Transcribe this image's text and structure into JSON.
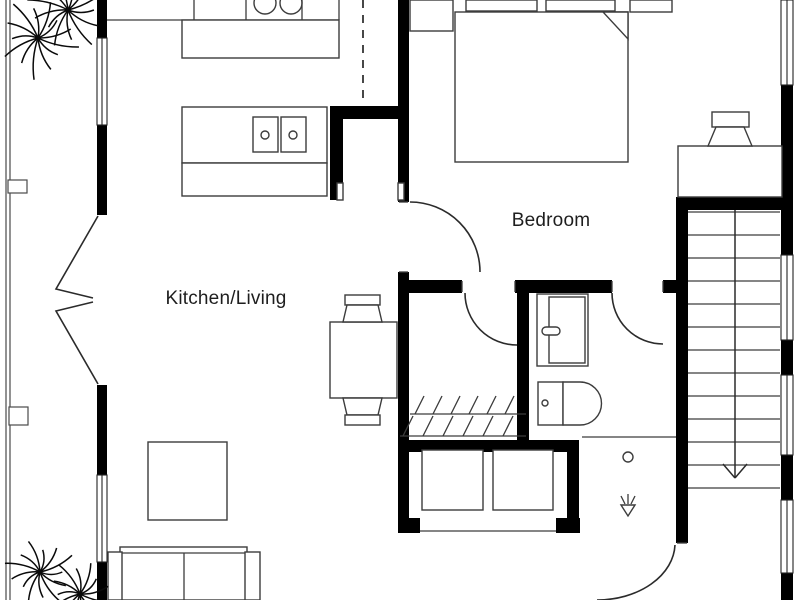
{
  "labels": {
    "bedroom": "Bedroom",
    "kitchen_living": "Kitchen/Living"
  },
  "label_positions": {
    "bedroom": {
      "x": 551,
      "y": 221
    },
    "kitchen_living": {
      "x": 226,
      "y": 299
    }
  },
  "colors": {
    "wall": "#000000",
    "line": "#3c3c3c",
    "door": "#2b2b2b",
    "thin": "#4a4a4a",
    "plant": "#0a0a0a",
    "background": "#ffffff",
    "text": "#1e1e1e"
  },
  "canvas": {
    "width": 800,
    "height": 600
  },
  "walls": [
    [
      97,
      0,
      10,
      38
    ],
    [
      97,
      125,
      10,
      90
    ],
    [
      97,
      385,
      10,
      90
    ],
    [
      97,
      562,
      10,
      38
    ],
    [
      781,
      85,
      12,
      170
    ],
    [
      781,
      340,
      12,
      35
    ],
    [
      781,
      455,
      12,
      45
    ],
    [
      781,
      573,
      12,
      27
    ],
    [
      398,
      0,
      11,
      202
    ],
    [
      398,
      272,
      11,
      261
    ],
    [
      398,
      280,
      64,
      13
    ],
    [
      515,
      280,
      97,
      13
    ],
    [
      663,
      280,
      19,
      13
    ],
    [
      517,
      293,
      12,
      147
    ],
    [
      398,
      440,
      180,
      12
    ],
    [
      567,
      440,
      12,
      93
    ],
    [
      398,
      518,
      22,
      15
    ],
    [
      556,
      518,
      24,
      15
    ],
    [
      330,
      106,
      78,
      13
    ],
    [
      330,
      106,
      13,
      94
    ],
    [
      676,
      197,
      12,
      346
    ],
    [
      676,
      197,
      107,
      13
    ]
  ],
  "windows": [
    [
      97,
      38,
      10,
      87
    ],
    [
      97,
      475,
      10,
      87
    ],
    [
      781,
      0,
      12,
      85
    ],
    [
      781,
      255,
      12,
      85
    ],
    [
      781,
      375,
      12,
      80
    ],
    [
      781,
      500,
      12,
      73
    ]
  ],
  "furniture": [
    {
      "name": "bed",
      "kind": "rect",
      "r": [
        455,
        12,
        173,
        150
      ]
    },
    {
      "name": "pillow",
      "kind": "rect",
      "r": [
        466,
        0,
        71,
        11
      ]
    },
    {
      "name": "pillow",
      "kind": "rect",
      "r": [
        546,
        0,
        69,
        11
      ]
    },
    {
      "name": "blanket-fold",
      "kind": "path",
      "d": "M603,12 L628,12 L628,39 Z"
    },
    {
      "name": "nightstand",
      "kind": "rect",
      "r": [
        410,
        0,
        43,
        31
      ]
    },
    {
      "name": "nightstand",
      "kind": "rect",
      "r": [
        630,
        0,
        42,
        12
      ]
    },
    {
      "name": "desk",
      "kind": "rect",
      "r": [
        678,
        146,
        104,
        51
      ]
    },
    {
      "name": "desk-chair-back",
      "kind": "rect",
      "r": [
        712,
        112,
        37,
        15
      ]
    },
    {
      "name": "desk-chair-seat",
      "kind": "path",
      "d": "M716,127 L744,127 L752,146 L708,146 Z"
    },
    {
      "name": "kitchen-counter-edge",
      "kind": "line",
      "p": [
        107,
        20,
        339,
        20
      ]
    },
    {
      "name": "kitchen-cabinet-divider",
      "kind": "line",
      "p": [
        194,
        0,
        194,
        20
      ]
    },
    {
      "name": "kitchen-cabinet-divider",
      "kind": "line",
      "p": [
        246,
        0,
        246,
        20
      ]
    },
    {
      "name": "kitchen-cabinet-divider",
      "kind": "line",
      "p": [
        302,
        0,
        302,
        20
      ]
    },
    {
      "name": "kitchen-cabinet-divider",
      "kind": "line",
      "p": [
        339,
        0,
        339,
        20
      ]
    },
    {
      "name": "kitchen-counter",
      "kind": "rect",
      "r": [
        182,
        20,
        157,
        38
      ]
    },
    {
      "name": "stove-burner",
      "kind": "circle",
      "c": [
        265,
        3,
        11
      ]
    },
    {
      "name": "stove-burner",
      "kind": "circle",
      "c": [
        291,
        3,
        11
      ]
    },
    {
      "name": "kitchen-island",
      "kind": "rect",
      "r": [
        182,
        107,
        145,
        56
      ]
    },
    {
      "name": "kitchen-island-counter",
      "kind": "rect",
      "r": [
        182,
        163,
        145,
        33
      ]
    },
    {
      "name": "sink-unit",
      "kind": "rect",
      "r": [
        253,
        117,
        25,
        35
      ]
    },
    {
      "name": "sink-unit",
      "kind": "rect",
      "r": [
        281,
        117,
        25,
        35
      ]
    },
    {
      "name": "sink-drain",
      "kind": "circle",
      "c": [
        265,
        135,
        4
      ]
    },
    {
      "name": "sink-drain",
      "kind": "circle",
      "c": [
        293,
        135,
        4
      ]
    },
    {
      "name": "pantry-door-jamb",
      "kind": "rect",
      "r": [
        337,
        183,
        6,
        17
      ]
    },
    {
      "name": "pantry-door-jamb",
      "kind": "rect",
      "r": [
        398,
        183,
        6,
        17
      ]
    },
    {
      "name": "dining-table",
      "kind": "rect",
      "r": [
        330,
        322,
        67,
        76
      ]
    },
    {
      "name": "dining-chair-back",
      "kind": "rect",
      "r": [
        345,
        295,
        35,
        10
      ]
    },
    {
      "name": "dining-chair-seat",
      "kind": "path",
      "d": "M347,305 L378,305 L382,322 L343,322 Z"
    },
    {
      "name": "dining-chair-seat",
      "kind": "path",
      "d": "M343,398 L382,398 L378,415 L347,415 Z"
    },
    {
      "name": "dining-chair-back",
      "kind": "rect",
      "r": [
        345,
        415,
        35,
        10
      ]
    },
    {
      "name": "rug",
      "kind": "rect",
      "r": [
        148,
        442,
        79,
        78
      ]
    },
    {
      "name": "sofa-body",
      "kind": "rect",
      "r": [
        120,
        547,
        127,
        53
      ]
    },
    {
      "name": "sofa-back-line",
      "kind": "line",
      "p": [
        120,
        553,
        247,
        553
      ]
    },
    {
      "name": "sofa-seat-divider",
      "kind": "line",
      "p": [
        184,
        553,
        184,
        600
      ]
    },
    {
      "name": "sofa-armrest",
      "kind": "rect",
      "r": [
        108,
        552,
        14,
        48
      ]
    },
    {
      "name": "sofa-armrest",
      "kind": "rect",
      "r": [
        245,
        552,
        15,
        48
      ]
    },
    {
      "name": "vanity",
      "kind": "rect",
      "r": [
        537,
        294,
        51,
        72
      ]
    },
    {
      "name": "vanity-basin",
      "kind": "rect",
      "r": [
        549,
        297,
        36,
        66
      ]
    },
    {
      "name": "faucet",
      "kind": "rect",
      "r": [
        542,
        327,
        18,
        8
      ],
      "rx": 4
    },
    {
      "name": "toilet-tank",
      "kind": "rect",
      "r": [
        538,
        382,
        25,
        43
      ]
    },
    {
      "name": "toilet-bowl",
      "kind": "path",
      "d": "M563,382 L580,382 A21.5,21.5 0 0 1 580,425 L563,425 Z"
    },
    {
      "name": "toilet-flush",
      "kind": "circle",
      "c": [
        545,
        403,
        3
      ]
    },
    {
      "name": "shower-edge",
      "kind": "line",
      "p": [
        582,
        437,
        676,
        437
      ]
    },
    {
      "name": "shower-drain",
      "kind": "circle",
      "c": [
        628,
        457,
        5
      ]
    },
    {
      "name": "showerhead-spray",
      "kind": "line",
      "p": [
        621,
        496,
        625,
        504
      ]
    },
    {
      "name": "showerhead-spray",
      "kind": "line",
      "p": [
        628,
        494,
        628,
        504
      ]
    },
    {
      "name": "showerhead-spray",
      "kind": "line",
      "p": [
        635,
        496,
        631,
        504
      ]
    },
    {
      "name": "showerhead-icon",
      "kind": "path",
      "d": "M621,505 L635,505 L628,516 Z"
    },
    {
      "name": "closet-rail",
      "kind": "line",
      "p": [
        410,
        414,
        526,
        414
      ]
    },
    {
      "name": "closet-rail",
      "kind": "line",
      "p": [
        400,
        436,
        526,
        436
      ]
    },
    {
      "name": "hanger",
      "kind": "line",
      "p": [
        424,
        396,
        415,
        414
      ]
    },
    {
      "name": "hanger",
      "kind": "line",
      "p": [
        442,
        396,
        433,
        414
      ]
    },
    {
      "name": "hanger",
      "kind": "line",
      "p": [
        460,
        396,
        451,
        414
      ]
    },
    {
      "name": "hanger",
      "kind": "line",
      "p": [
        478,
        396,
        469,
        414
      ]
    },
    {
      "name": "hanger",
      "kind": "line",
      "p": [
        496,
        396,
        487,
        414
      ]
    },
    {
      "name": "hanger",
      "kind": "line",
      "p": [
        514,
        396,
        505,
        414
      ]
    },
    {
      "name": "hanger",
      "kind": "line",
      "p": [
        413,
        416,
        403,
        436
      ]
    },
    {
      "name": "hanger",
      "kind": "line",
      "p": [
        433,
        416,
        423,
        436
      ]
    },
    {
      "name": "hanger",
      "kind": "line",
      "p": [
        453,
        416,
        443,
        436
      ]
    },
    {
      "name": "hanger",
      "kind": "line",
      "p": [
        473,
        416,
        463,
        436
      ]
    },
    {
      "name": "hanger",
      "kind": "line",
      "p": [
        493,
        416,
        483,
        436
      ]
    },
    {
      "name": "hanger",
      "kind": "line",
      "p": [
        513,
        416,
        503,
        436
      ]
    },
    {
      "name": "storage-box",
      "kind": "rect",
      "r": [
        422,
        450,
        61,
        60
      ]
    },
    {
      "name": "storage-box",
      "kind": "rect",
      "r": [
        493,
        450,
        60,
        60
      ]
    },
    {
      "name": "threshold",
      "kind": "line",
      "p": [
        420,
        531,
        556,
        531
      ]
    },
    {
      "name": "door-jamb",
      "kind": "line",
      "p": [
        462,
        281,
        462,
        292
      ]
    },
    {
      "name": "door-jamb",
      "kind": "line",
      "p": [
        515,
        281,
        515,
        292
      ]
    },
    {
      "name": "door-jamb",
      "kind": "line",
      "p": [
        612,
        281,
        612,
        292
      ]
    },
    {
      "name": "door-jamb",
      "kind": "line",
      "p": [
        663,
        281,
        663,
        292
      ]
    },
    {
      "name": "door-jamb",
      "kind": "line",
      "p": [
        399,
        202,
        408,
        202
      ]
    },
    {
      "name": "door-jamb",
      "kind": "line",
      "p": [
        399,
        272,
        408,
        272
      ]
    },
    {
      "name": "door-jamb",
      "kind": "line",
      "p": [
        677,
        543,
        687,
        543
      ]
    }
  ],
  "doors": [
    {
      "name": "bedroom-door-arc",
      "d": "M410,202 A70,70 0 0 1 480,272"
    },
    {
      "name": "closet-door-arc",
      "d": "M465,293 A52,52 0 0 0 517,345"
    },
    {
      "name": "bathroom-door-arc",
      "d": "M612,293 A51,51 0 0 0 663,344"
    },
    {
      "name": "entry-door-arc",
      "d": "M675,545 A78,57 0 0 1 597,600"
    },
    {
      "name": "balcony-folding-door-leaf",
      "d": "M98,216 L56,289 L93,298"
    },
    {
      "name": "balcony-folding-door-leaf",
      "d": "M98,384 L56,311 L93,302"
    }
  ],
  "dashed_lines": [
    [
      363,
      0,
      363,
      105
    ]
  ],
  "balcony": {
    "lines": [
      [
        6,
        0,
        6,
        600
      ],
      [
        10,
        0,
        10,
        600
      ]
    ],
    "posts": [
      [
        8,
        180,
        19,
        13
      ],
      [
        9,
        407,
        19,
        18
      ]
    ]
  },
  "stairs": {
    "x1": 688,
    "x2": 780,
    "tread_y0": 212,
    "tread_step": 23,
    "tread_count": 13,
    "stringer_x": 735,
    "stringer_y1": 210,
    "stringer_y2": 478,
    "arrow": [
      [
        723,
        464,
        735,
        478
      ],
      [
        747,
        464,
        735,
        478
      ]
    ],
    "direction": "down"
  },
  "plants": [
    {
      "name": "plant-top-left",
      "clusters": [
        [
          68,
          10
        ],
        [
          38,
          38
        ]
      ],
      "leaf": 36
    },
    {
      "name": "plant-bottom-left",
      "clusters": [
        [
          40,
          572
        ],
        [
          80,
          594
        ]
      ],
      "leaf": 31
    }
  ]
}
